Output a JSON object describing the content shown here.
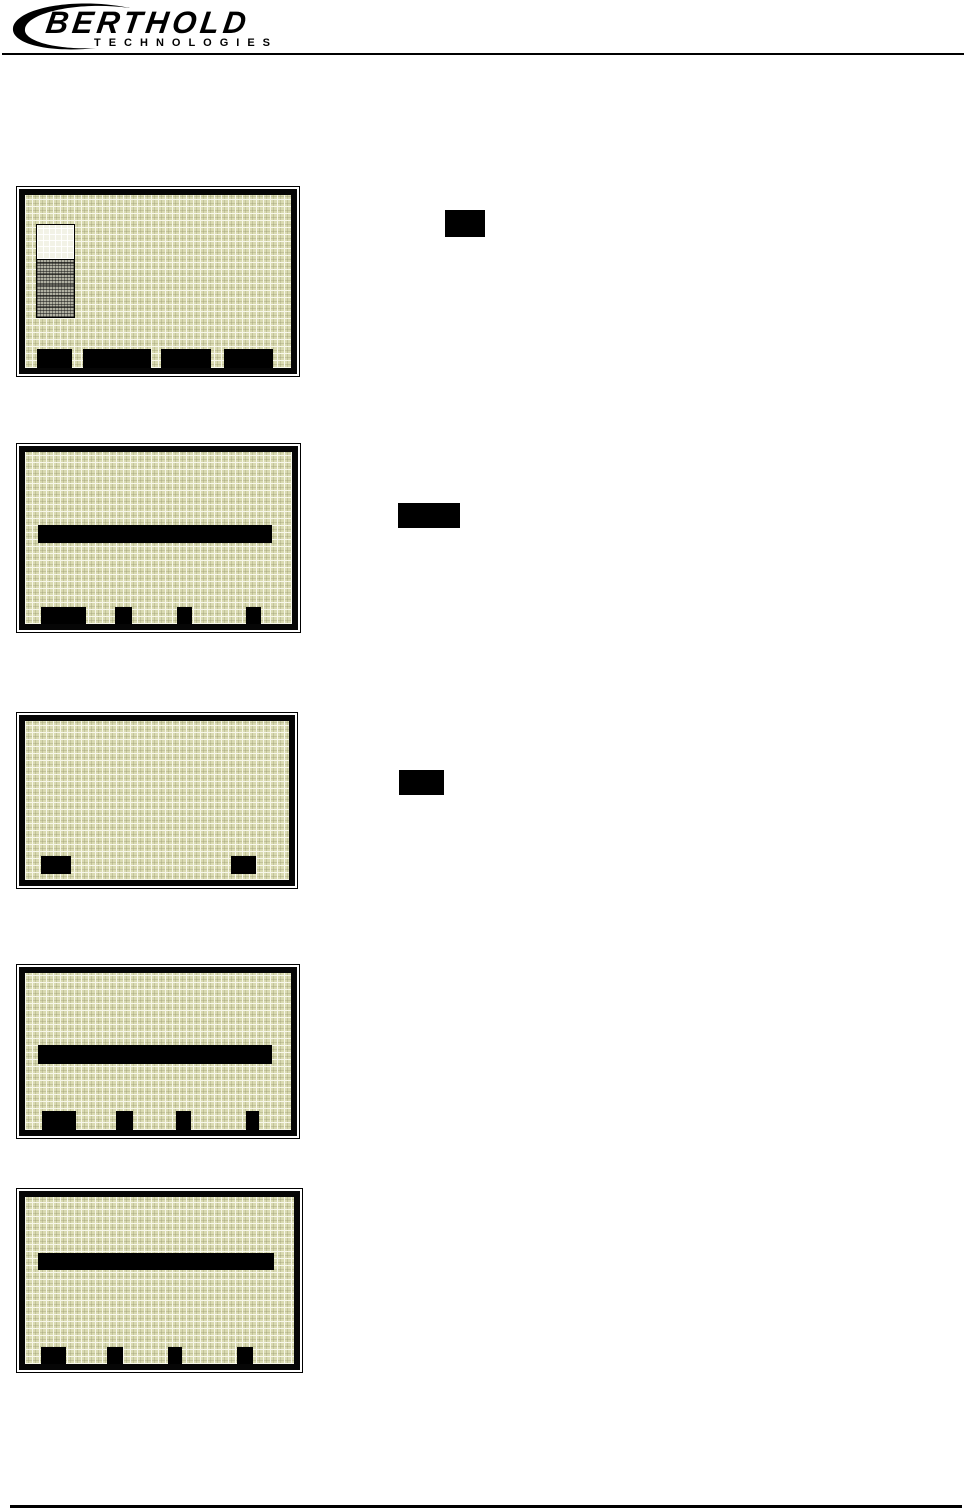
{
  "header": {
    "brand": "BERTHOLD",
    "subbrand": "TECHNOLOGIES"
  },
  "colors": {
    "page_background": "#ffffff",
    "ink": "#000000",
    "lcd_background": "#d9dab1",
    "lcd_grid_light": "#f7f7ea",
    "lcd_grid_dark": "#babb94",
    "tank_empty": "#f2f2e6",
    "tank_fill_gray": "#b0b0a2",
    "highlight_bar": "#000000",
    "softkey_black": "#000000"
  },
  "screens": [
    {
      "id": "lcd-screen-1",
      "softkeys": 4,
      "selection_bar": false,
      "tank_indicator": true,
      "tank_fill_percent": 62
    },
    {
      "id": "lcd-screen-2",
      "softkeys": 4,
      "selection_bar": true,
      "tank_indicator": false
    },
    {
      "id": "lcd-screen-3",
      "softkeys": 2,
      "selection_bar": false,
      "tank_indicator": false
    },
    {
      "id": "lcd-screen-4",
      "softkeys": 4,
      "selection_bar": true,
      "tank_indicator": false
    },
    {
      "id": "lcd-screen-5",
      "softkeys": 4,
      "selection_bar": true,
      "tank_indicator": false
    }
  ],
  "key_callouts": [
    {
      "id": "key-callout-1"
    },
    {
      "id": "key-callout-2"
    },
    {
      "id": "key-callout-3"
    }
  ]
}
